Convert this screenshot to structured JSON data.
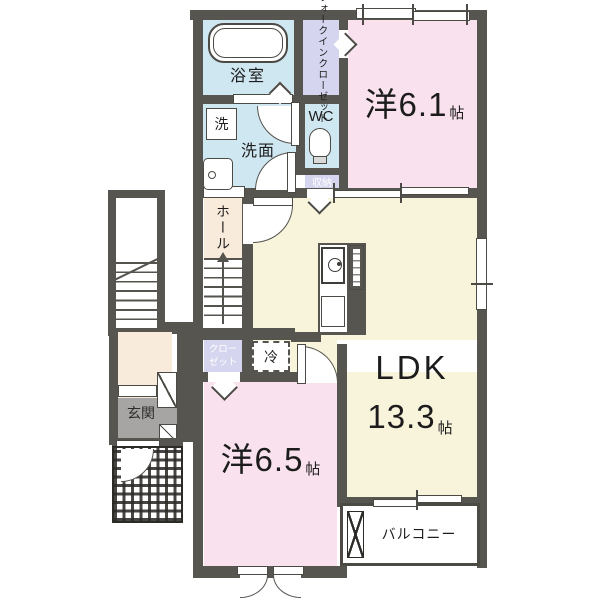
{
  "rooms": {
    "bathroom": {
      "label": "浴室"
    },
    "walk_in_closet": {
      "line1": "ウォークイン",
      "line2": "クローゼット"
    },
    "bedroom_6_1": {
      "name": "洋6.1",
      "unit": "帖"
    },
    "laundry": {
      "label": "洗"
    },
    "washroom": {
      "label": "洗面"
    },
    "wc": {
      "label": "WC"
    },
    "storage": {
      "label": "収納"
    },
    "hall": {
      "label": "ホール"
    },
    "closet": {
      "line1": "クロー",
      "line2": "ゼット"
    },
    "refrigerator": {
      "label": "冷"
    },
    "ldk": {
      "name": "LDK",
      "size": "13.3",
      "unit": "帖"
    },
    "bedroom_6_5": {
      "name": "洋6.5",
      "unit": "帖"
    },
    "entrance": {
      "label": "玄関"
    },
    "balcony": {
      "label": "バルコニー"
    }
  },
  "colors": {
    "wall": "#57554f",
    "room_pink": "#f9e2ed",
    "room_blue": "#cfe7f1",
    "room_lavender": "#d6d5ef",
    "room_cream": "#f8f3db",
    "hall_cream": "#f9ebdb",
    "genkan_gray": "#a7a5a3"
  }
}
